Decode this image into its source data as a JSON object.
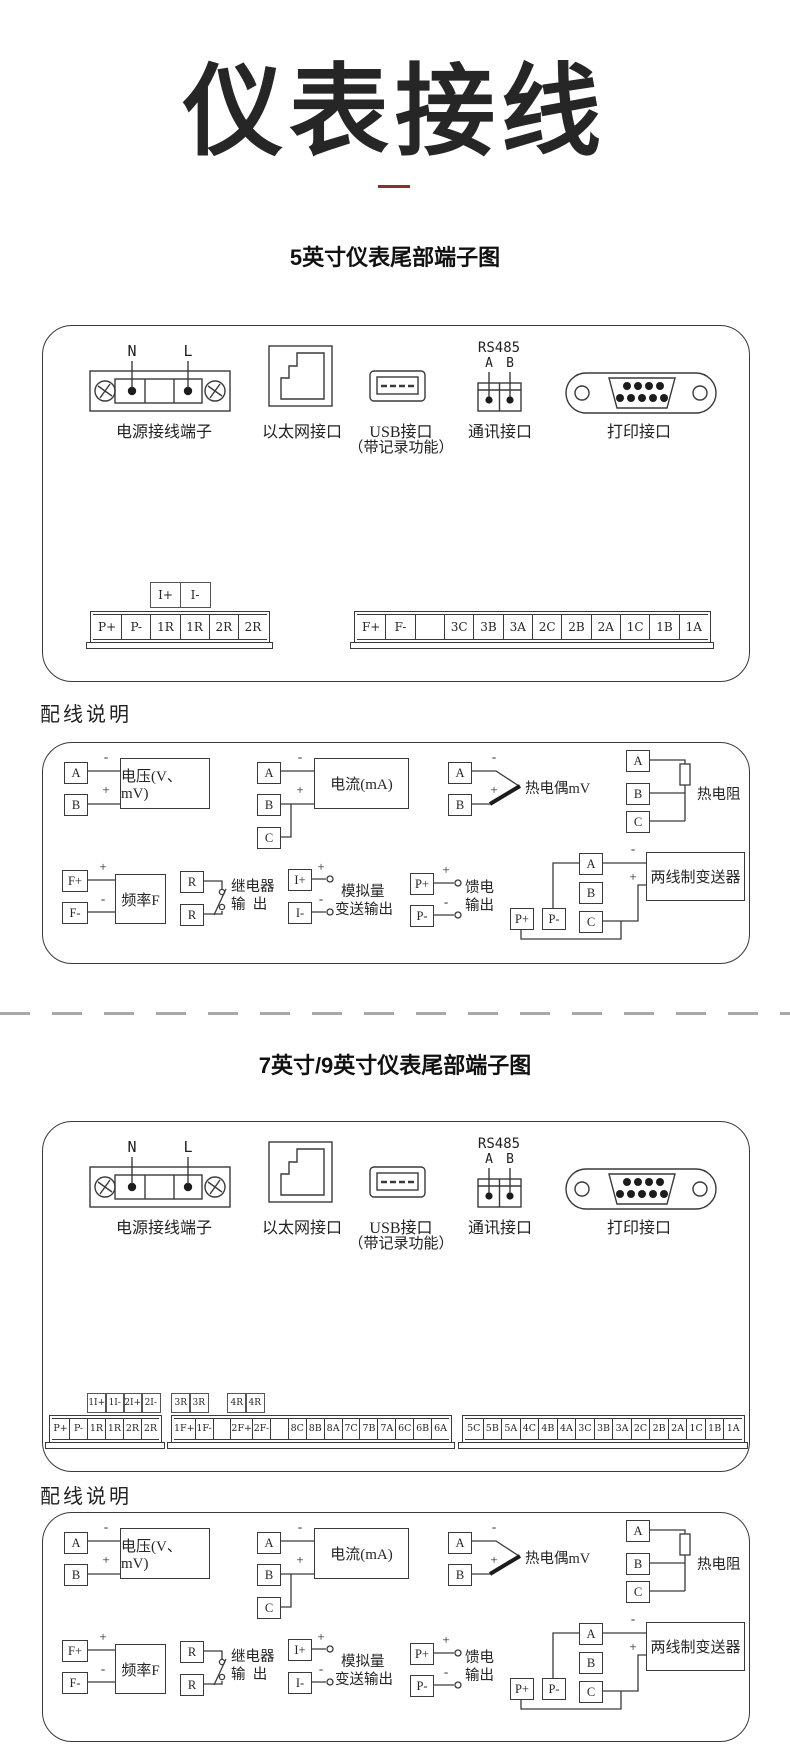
{
  "page": {
    "title": "仪表接线",
    "section1_title": "5英寸仪表尾部端子图",
    "section2_title": "7英寸/9英寸仪表尾部端子图",
    "wiring_heading": "配线说明"
  },
  "colors": {
    "accent_dash": "#8a3030",
    "line": "#3a3a3a"
  },
  "ports": {
    "n": "N",
    "l": "L",
    "power_label": "电源接线端子",
    "ethernet_label": "以太网接口",
    "usb_label_line1": "USB接口",
    "usb_label_line2": "（带记录功能）",
    "rs485": "RS485",
    "a": "A",
    "b": "B",
    "comm_label": "通讯接口",
    "print_label": "打印接口"
  },
  "section1_strips": {
    "aux": [
      "I+",
      "I-"
    ],
    "left": [
      "P+",
      "P-",
      "1R",
      "1R",
      "2R",
      "2R"
    ],
    "right": [
      "F+",
      "F-",
      "",
      "3C",
      "3B",
      "3A",
      "2C",
      "2B",
      "2A",
      "1C",
      "1B",
      "1A"
    ]
  },
  "section2_strips": {
    "aux1": [
      "1I+",
      "1I-",
      "2I+",
      "2I-"
    ],
    "aux2": [
      "3R",
      "3R"
    ],
    "aux3": [
      "4R",
      "4R"
    ],
    "g1": [
      "P+",
      "P-",
      "1R",
      "1R",
      "2R",
      "2R"
    ],
    "g2": [
      "1F+",
      "1F-",
      "",
      "2F+",
      "2F-",
      "",
      "8C",
      "8B",
      "8A",
      "7C",
      "7B",
      "7A",
      "6C",
      "6B",
      "6A"
    ],
    "g3": [
      "5C",
      "5B",
      "5A",
      "4C",
      "4B",
      "4A",
      "3C",
      "3B",
      "3A",
      "2C",
      "2B",
      "2A",
      "1C",
      "1B",
      "1A"
    ]
  },
  "wiring": {
    "voltage_label": "电压(V、mV)",
    "current_label": "电流(mA)",
    "thermocouple_label": "热电偶mV",
    "rtd_label": "热电阻",
    "frequency_label": "频率F",
    "relay_label_line1": "继电器",
    "relay_label_line2": "输  出",
    "analog_label_line1": "模拟量",
    "analog_label_line2": "变送输出",
    "feed_label_line1": "馈电",
    "feed_label_line2": "输出",
    "transmitter_label": "两线制变送器",
    "t_a": "A",
    "t_b": "B",
    "t_c": "C",
    "t_fp": "F+",
    "t_fm": "F-",
    "t_r": "R",
    "t_ip": "I+",
    "t_im": "I-",
    "t_pp": "P+",
    "t_pm": "P-",
    "plus": "+",
    "minus": "-"
  }
}
